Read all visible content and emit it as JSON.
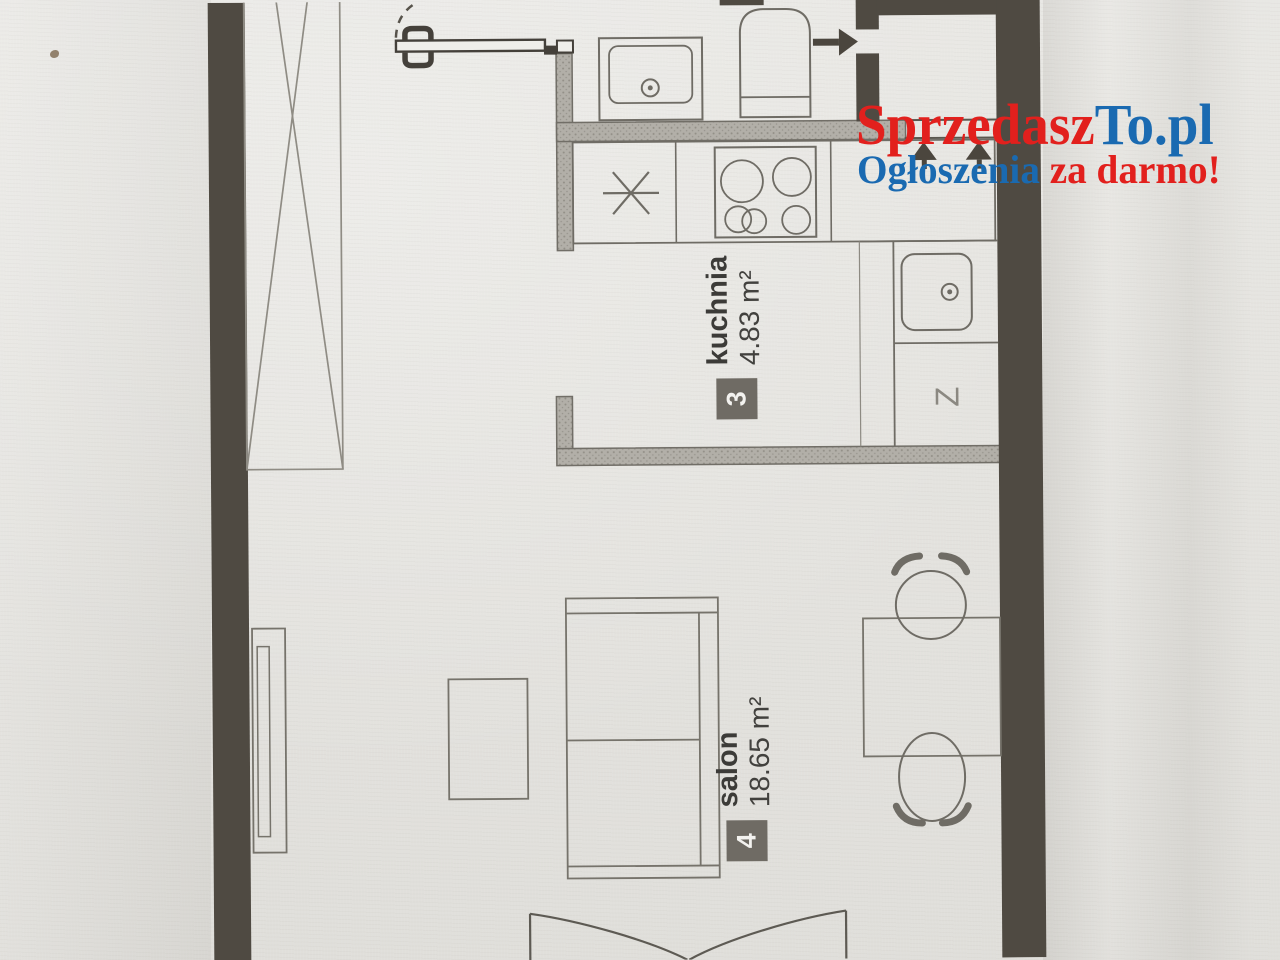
{
  "watermark": {
    "brand_red": "Sprzedasz",
    "brand_blue": "To.pl",
    "tagline_blue": "Ogłoszenia ",
    "tagline_red": "za darmo!",
    "color_red": "#e2201d",
    "color_blue": "#1a6ab1"
  },
  "rooms": [
    {
      "number": "3",
      "name": "kuchnia",
      "area": "4.83 m²"
    },
    {
      "number": "4",
      "name": "salon",
      "area": "18.65 m²"
    }
  ],
  "labels": {
    "appliance": "Z"
  },
  "plan_colors": {
    "structural_wall": "#4f4a42",
    "partition_wall": "#b2afa8",
    "linework": "#6f6c65",
    "room_badge": "#6f6b64",
    "paper": "#e7e6e2"
  },
  "icons": [
    "wardrobe-icon",
    "entry-door-icon",
    "shower-tray-icon",
    "tall-appliance-icon",
    "washing-machine-symbol",
    "stove-icon",
    "kitchen-sink-icon",
    "entrance-arrow-icon",
    "vent-arrow-icon",
    "tv-cabinet-icon",
    "coffee-table-icon",
    "sofa-icon",
    "dining-table-icon",
    "chair-icon",
    "balcony-door-icon"
  ]
}
